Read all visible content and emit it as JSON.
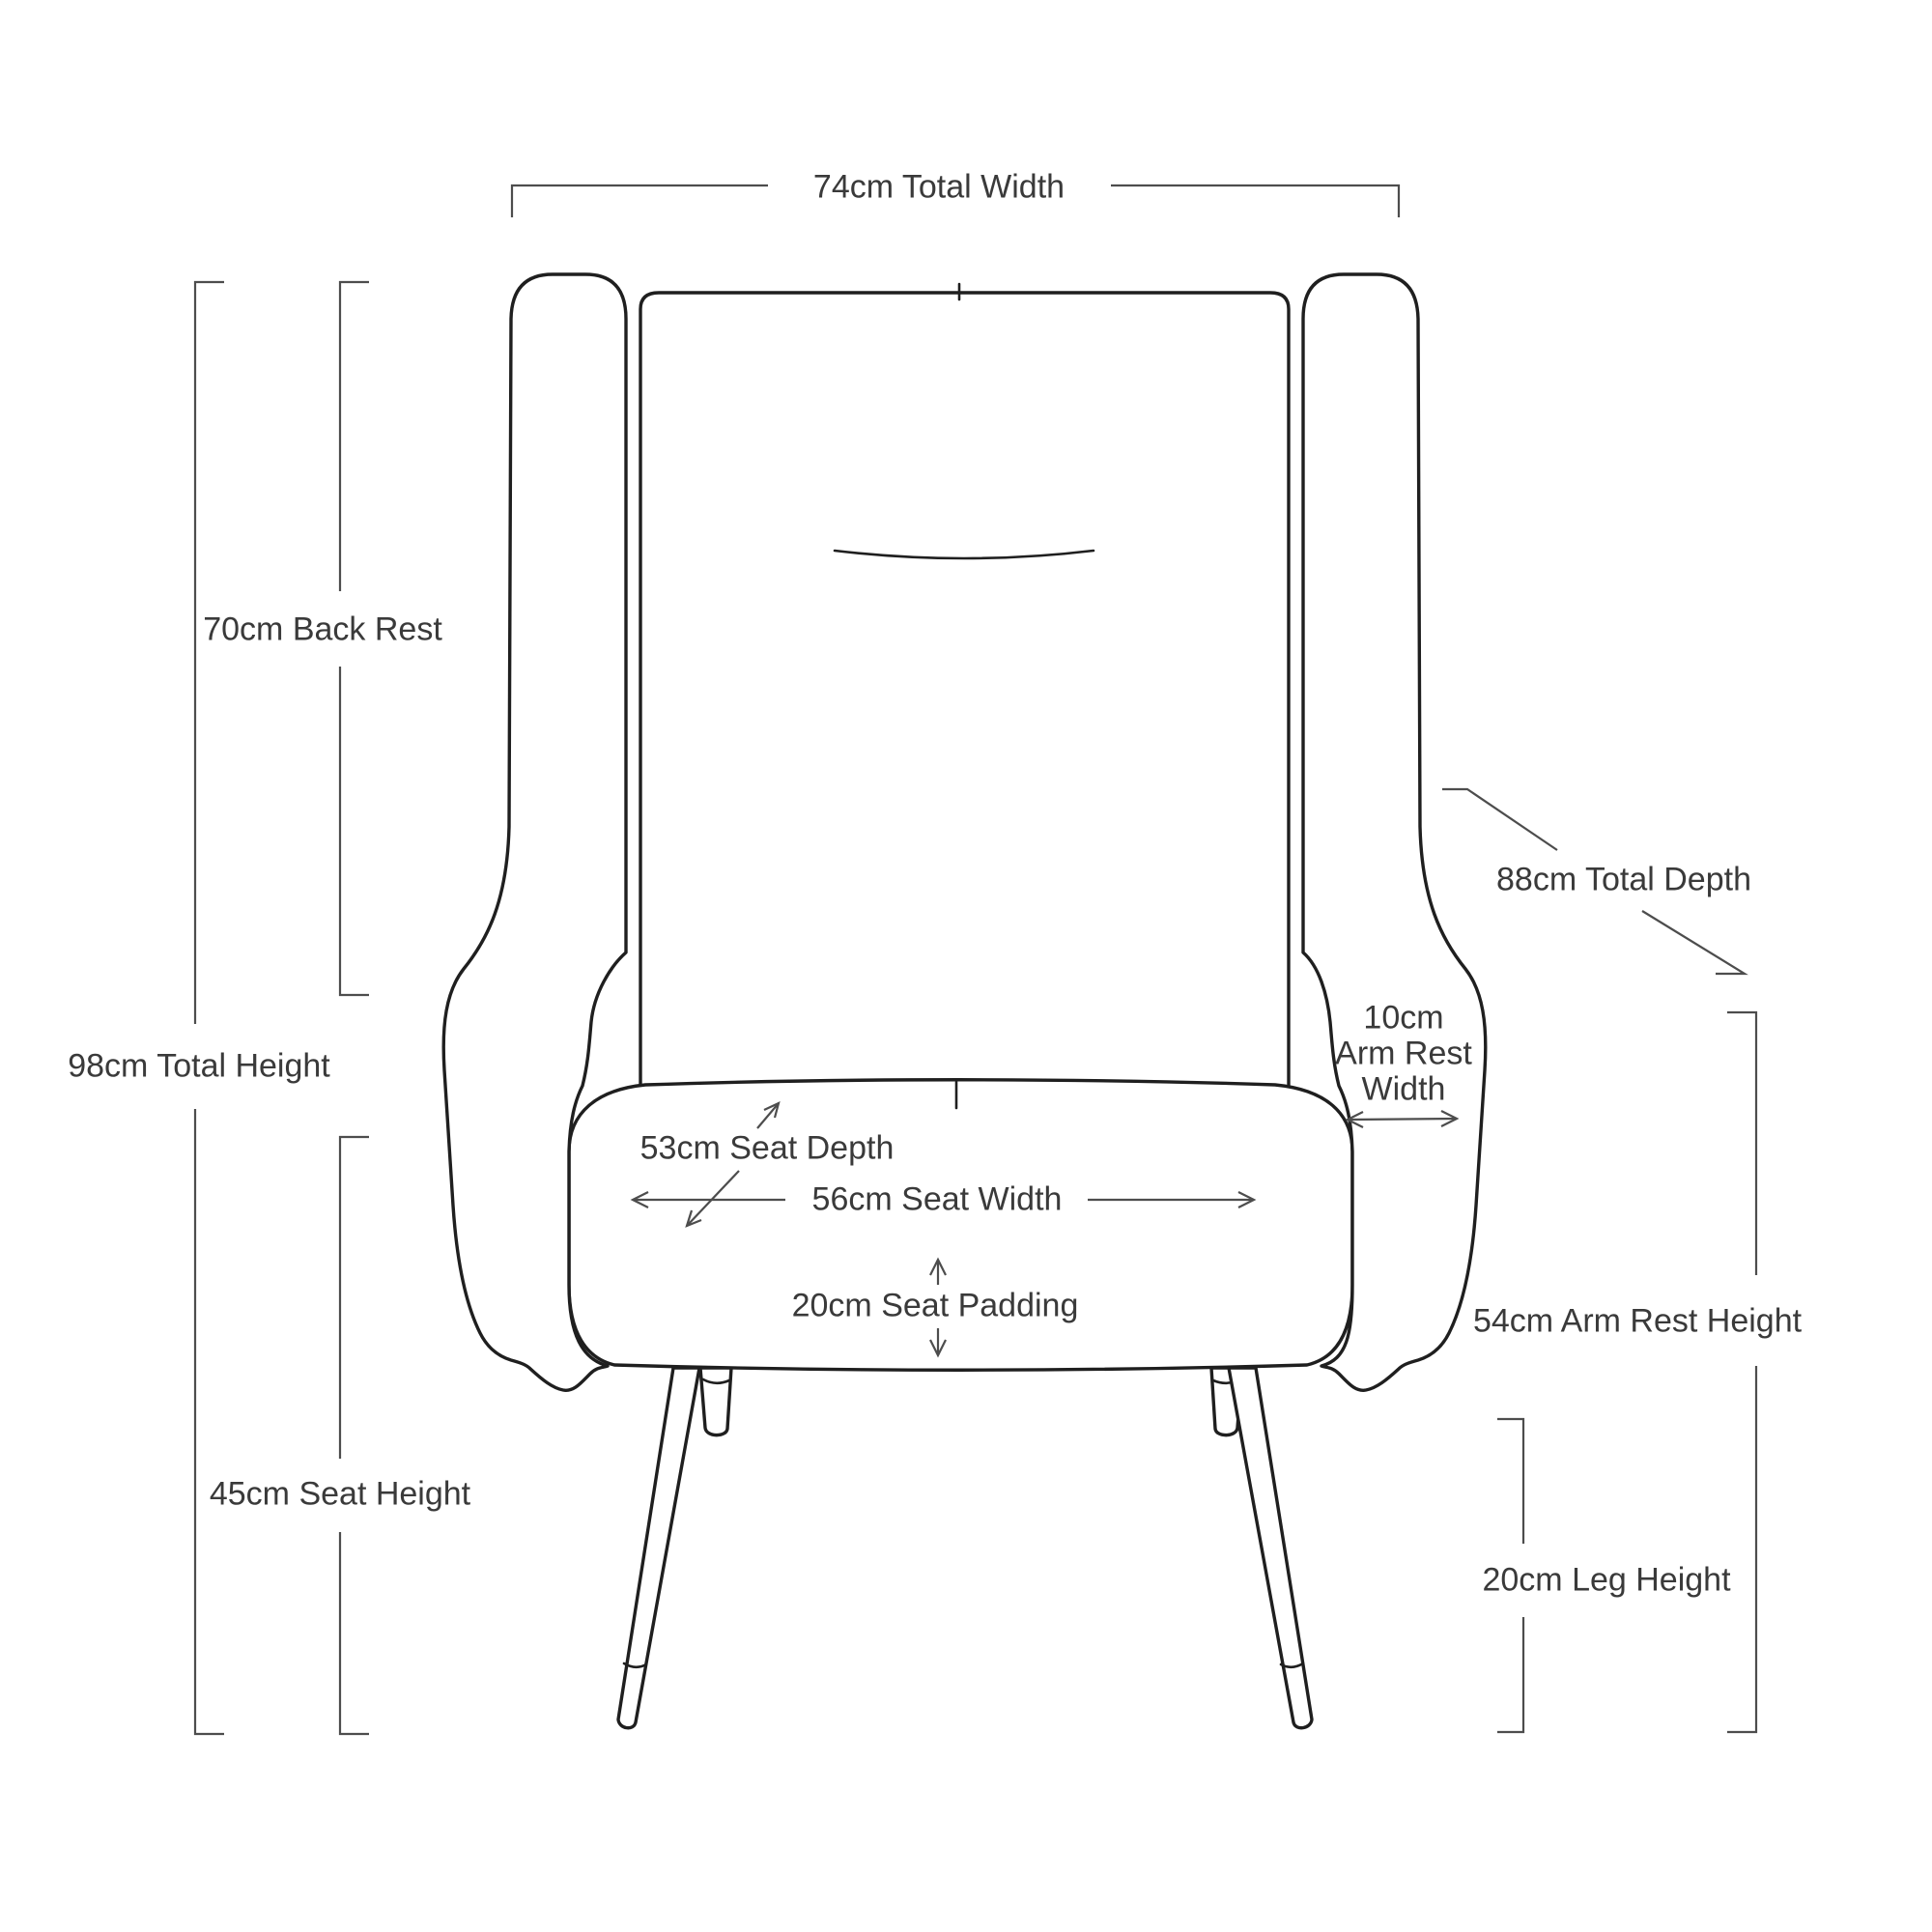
{
  "diagram": {
    "title": "Armchair dimension diagram (front view line drawing)",
    "labels": {
      "total_width": "74cm Total Width",
      "back_rest": "70cm Back Rest",
      "total_height": "98cm Total Height",
      "seat_height": "45cm Seat Height",
      "total_depth": "88cm Total Depth",
      "arm_rest_width_line1": "10cm",
      "arm_rest_width_line2": "Arm Rest",
      "arm_rest_width_line3": "Width",
      "arm_rest_height": "54cm Arm Rest Height",
      "leg_height": "20cm Leg Height",
      "seat_depth": "53cm Seat Depth",
      "seat_width": "56cm Seat Width",
      "seat_padding": "20cm Seat Padding"
    },
    "colors": {
      "background": "#ffffff",
      "chair_line": "#1f1f1f",
      "dimension_line": "#4d4d4d",
      "text": "#3a3a3a"
    }
  }
}
